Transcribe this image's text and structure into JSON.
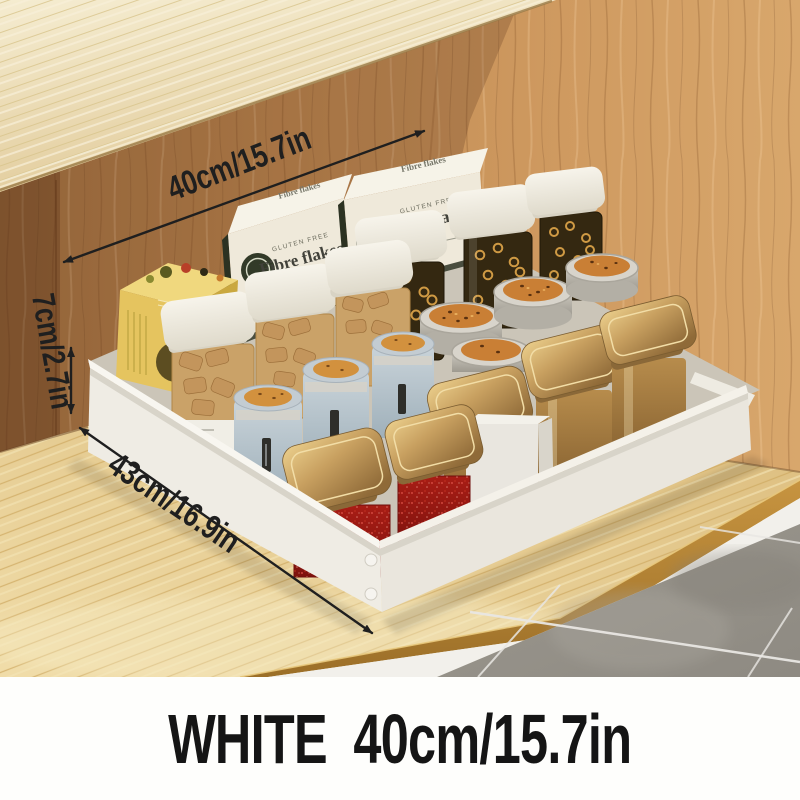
{
  "scene": {
    "alt_text": "White pull-out storage drawer filled with food containers on a wooden cabinet shelf, with size annotations"
  },
  "caption": {
    "text": "WHITE  40cm/15.7in"
  },
  "dimensions": {
    "width": {
      "label": "40cm/15.7in"
    },
    "height": {
      "label": "7cm/2.7in"
    },
    "depth": {
      "label": "43cm/16.9in"
    }
  },
  "products": {
    "cereal_box": {
      "name": "Fibre flakes",
      "tagline": "GLUTEN FREE"
    }
  },
  "colors": {
    "wall_wood": "#c28a54",
    "upper_trim_wood": "#ecdcae",
    "shelf_wood": "#e7cd92",
    "shelf_edge_wood": "#b98733",
    "drawer_white": "#efece4",
    "baseboard_white": "#f2f0eb",
    "tile_gray": "#96928a",
    "grout_white": "#e9e7e3",
    "annotation_black": "#1f1f1f",
    "caption_text": "#151515",
    "cereal_box_cream": "#efe9da",
    "yellow_box": "#e5c45f",
    "blue_canister": "#b9c7d2",
    "gold_lid": "#c09a5c",
    "bronze_body": "#a07840",
    "red_jar": "#9e1a14",
    "tin_top_orange": "#c97f35"
  }
}
